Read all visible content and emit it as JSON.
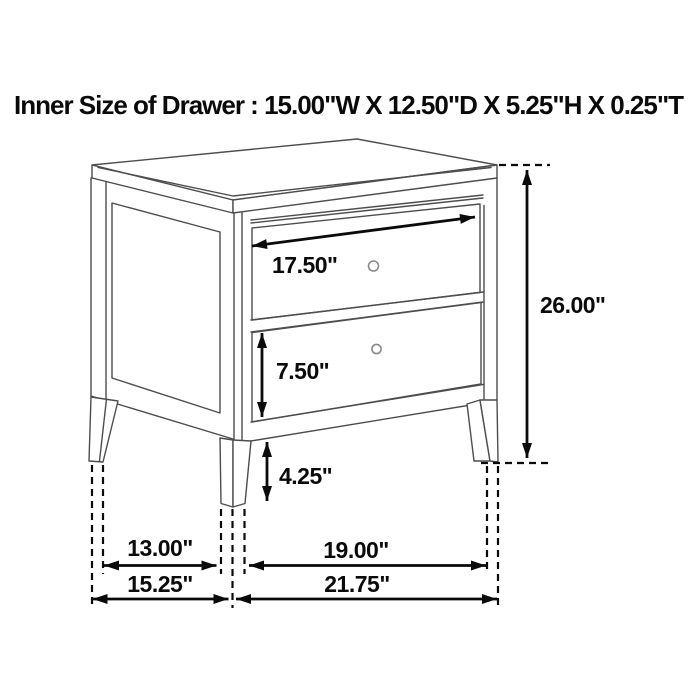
{
  "title": "Inner Size of Drawer : 15.00\"W X 12.50\"D X 5.25\"H X 0.25\"T",
  "diagram": {
    "kind": "furniture-dimension-line-drawing",
    "item": "two-drawer nightstand",
    "drawer_count": 2,
    "dims": {
      "drawer_width": "17.50\"",
      "overall_height": "26.00\"",
      "drawer_face_height": "7.50\"",
      "leg_height": "4.25\"",
      "side_leg_span": "13.00\"",
      "side_overall_depth": "15.25\"",
      "front_leg_span": "19.00\"",
      "front_overall_width": "21.75\""
    }
  },
  "colors": {
    "background": "#ffffff",
    "drawing_line": "#4d4d4d",
    "annotation": "#0a0a0a",
    "knob": "#8a8a8a"
  }
}
